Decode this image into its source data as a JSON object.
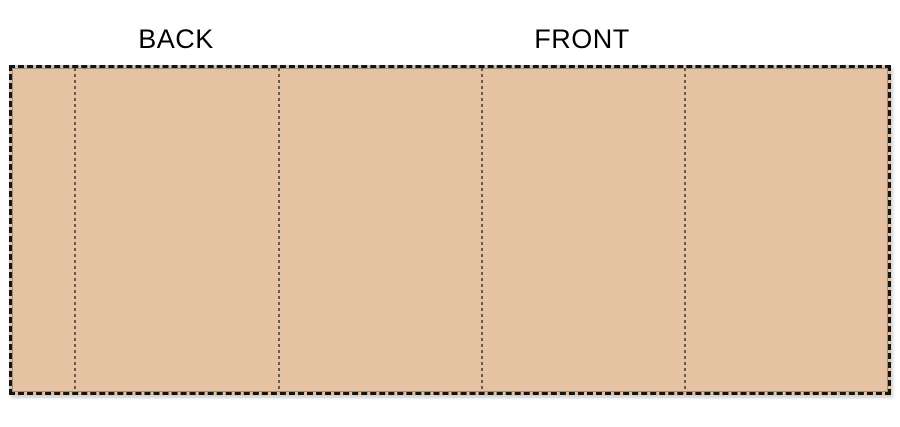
{
  "diagram": {
    "type": "label-wrap-template",
    "back_label": "BACK",
    "front_label": "FRONT",
    "rectangle": {
      "fill_color": "#E5C3A2",
      "outline_color": "#A08D7C",
      "cut_border_color": "#141414",
      "cut_border_style": "dashed",
      "content_left_px": 12,
      "content_top_px": 68,
      "content_width_px": 876,
      "content_height_px": 324
    },
    "fold_lines": {
      "style": "dotted",
      "color": "#6B5A4C",
      "x_positions_px": [
        62,
        266,
        469,
        672
      ]
    },
    "panels": [
      {
        "name": "left-flap",
        "label": ""
      },
      {
        "name": "back-panel",
        "label": "BACK"
      },
      {
        "name": "side-panel-1",
        "label": ""
      },
      {
        "name": "front-panel",
        "label": "FRONT"
      },
      {
        "name": "side-panel-2",
        "label": ""
      }
    ]
  }
}
